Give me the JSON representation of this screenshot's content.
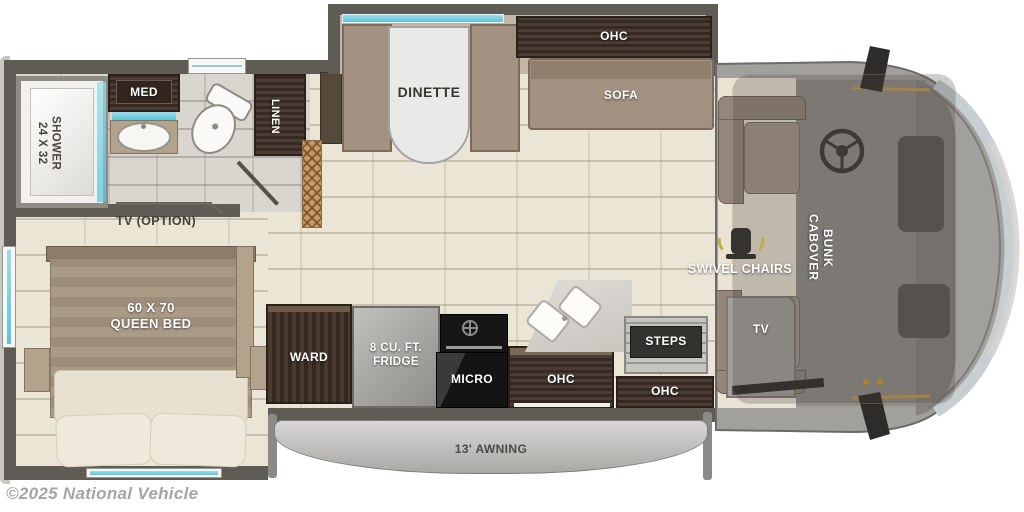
{
  "labels": {
    "shower": "24 X 32\nSHOWER",
    "med": "MED",
    "linen": "LINEN",
    "dinette": "DINETTE",
    "sofa_ohc": "OHC",
    "sofa": "SOFA",
    "tv_option": "TV (OPTION)",
    "queen_bed": "60 X 70\nQUEEN BED",
    "ward": "WARD",
    "fridge": "8 CU. FT.\nFRIDGE",
    "micro": "MICRO",
    "kitchen_ohc": "OHC",
    "steps": "STEPS",
    "entry_ohc": "OHC",
    "tv": "TV",
    "swivel_chairs": "SWIVEL CHAIRS",
    "cabover_bunk": "CABOVER\nBUNK",
    "awning": "13' AWNING"
  },
  "watermark": "©2025 National Vehicle",
  "colors": {
    "wall": "#5f5c56",
    "floor": "#ebe5d5",
    "bath_floor": "#d9d6d0",
    "cabinet_wood": "#41322a",
    "upholstery_tan": "#a39282",
    "window_teal": "#7fd0e2",
    "cab_gray": "#a2a09c",
    "trim_gold": "#c79a4e"
  }
}
